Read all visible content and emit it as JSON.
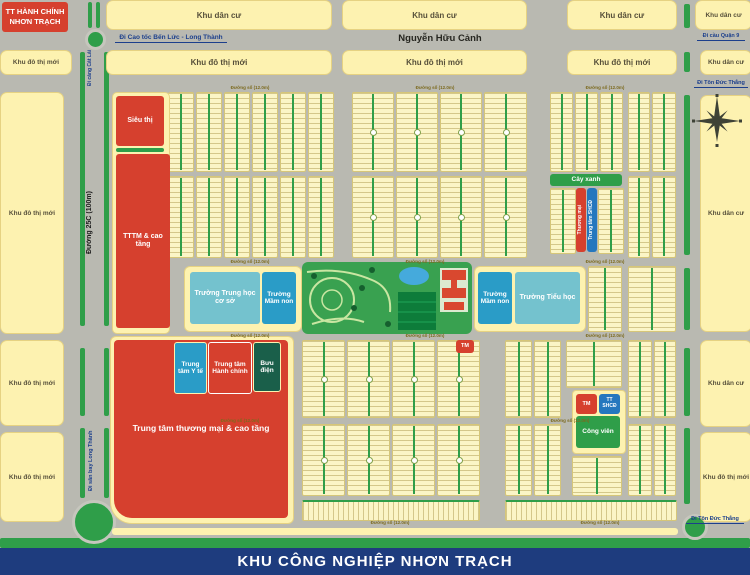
{
  "admin_box": {
    "line1": "TT HÀNH CHÍNH",
    "line2": "NHƠN TRẠCH"
  },
  "banner": "KHU CÔNG NGHIỆP NHƠN TRẠCH",
  "zone_labels": {
    "khu_dan_cu": "Khu dân cư",
    "khu_do_thi_moi": "Khu đô thị mới"
  },
  "roads": {
    "nguyen_huu_canh": "Nguyễn Hữu Cảnh",
    "duong_25c": "Đường 25C (100m)",
    "di_cao_toc_ben_luc": "Đi Cao tốc Bến Lức - Long Thành",
    "di_cang_cat_lai": "Đi cảng Cát Lái",
    "di_cau_quan_9": "Đi cầu Quận 9",
    "di_ton_duc_thang": "Đi Tôn Đức Thắng",
    "di_san_bay_long_thanh": "Đi sân bay Long Thành",
    "street_minor": "Đường số (12.0m)"
  },
  "facilities": {
    "sieu_thi": "Siêu thị",
    "tttm_cao_tang": "TTTM & cao tầng",
    "truong_thcs": "Trường Trung học cơ sở",
    "truong_mam_non": "Trường Mầm non",
    "truong_tieu_hoc": "Trường Tiểu học",
    "trung_tam_y_te": "Trung tâm Y tế",
    "trung_tam_hanh_chinh": "Trung tâm Hành chính",
    "buu_dien": "Bưu điện",
    "trung_tam_thuong_mai": "Trung tâm thương mại & cao tầng",
    "cay_xanh": "Cây xanh",
    "thuong_mai": "Thương mại",
    "trung_tam_shcd": "Trung tâm SHCĐ",
    "tm": "TM",
    "tt_shcd": "TT SHCĐ",
    "cong_vien": "Công viên"
  },
  "icons": {
    "compass": "8-point compass rose"
  },
  "colors": {
    "road_gray": "#b9b9b1",
    "block_yellow": "#fdf2b0",
    "lot_cream": "#fbf5c6",
    "red": "#d6402e",
    "green": "#2f9e49",
    "sports_field_green": "#0d7c3a",
    "school_light_blue": "#74c2ce",
    "medical_blue": "#2a9cc7",
    "community_blue": "#2577be",
    "post_dark_green": "#1a5f4a",
    "banner_navy": "#1e3c7e",
    "pond_blue": "#45aadc"
  }
}
